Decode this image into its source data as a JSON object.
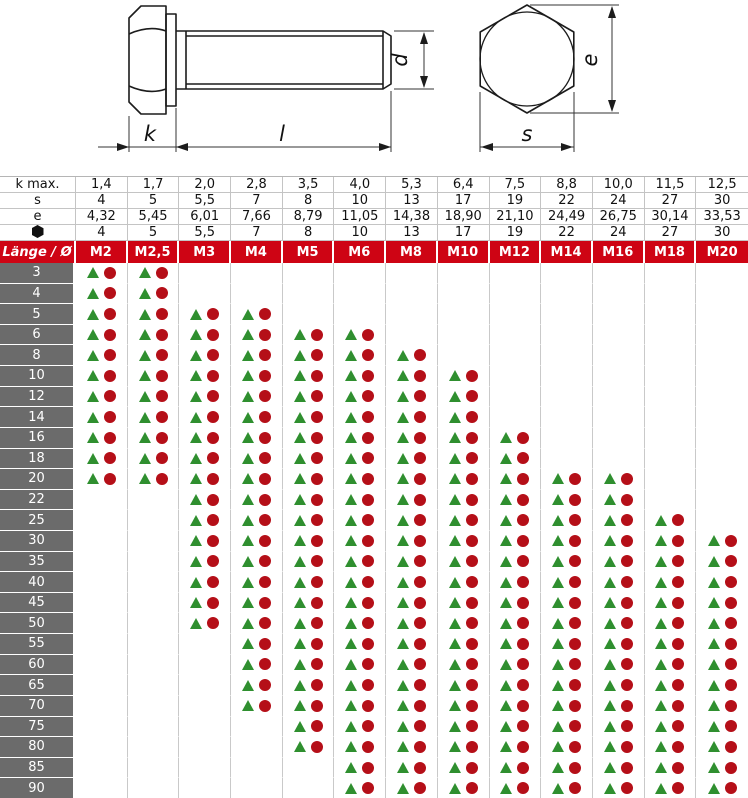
{
  "drawing": {
    "dim_labels": {
      "head_height": "k",
      "shank_length": "l",
      "diameter": "d",
      "corner_width": "e",
      "flat_width": "s"
    }
  },
  "spec": {
    "rows": [
      {
        "label": "k max.",
        "values": [
          "1,4",
          "1,7",
          "2,0",
          "2,8",
          "3,5",
          "4,0",
          "5,3",
          "6,4",
          "7,5",
          "8,8",
          "10,0",
          "11,5",
          "12,5"
        ]
      },
      {
        "label": "s",
        "values": [
          "4",
          "5",
          "5,5",
          "7",
          "8",
          "10",
          "13",
          "17",
          "19",
          "22",
          "24",
          "27",
          "30"
        ]
      },
      {
        "label": "e",
        "values": [
          "4,32",
          "5,45",
          "6,01",
          "7,66",
          "8,79",
          "11,05",
          "14,38",
          "18,90",
          "21,10",
          "24,49",
          "26,75",
          "30,14",
          "33,53"
        ]
      },
      {
        "label": "",
        "icon": "black-hexagon",
        "values": [
          "4",
          "5",
          "5,5",
          "7",
          "8",
          "10",
          "13",
          "17",
          "19",
          "22",
          "24",
          "27",
          "30"
        ]
      }
    ]
  },
  "table": {
    "corner_label": "Länge / Ø",
    "columns": [
      "M2",
      "M2,5",
      "M3",
      "M4",
      "M5",
      "M6",
      "M8",
      "M10",
      "M12",
      "M14",
      "M16",
      "M18",
      "M20"
    ],
    "rows": [
      {
        "length": "3",
        "cells": [
          1,
          1,
          0,
          0,
          0,
          0,
          0,
          0,
          0,
          0,
          0,
          0,
          0
        ]
      },
      {
        "length": "4",
        "cells": [
          1,
          1,
          0,
          0,
          0,
          0,
          0,
          0,
          0,
          0,
          0,
          0,
          0
        ]
      },
      {
        "length": "5",
        "cells": [
          1,
          1,
          1,
          1,
          0,
          0,
          0,
          0,
          0,
          0,
          0,
          0,
          0
        ]
      },
      {
        "length": "6",
        "cells": [
          1,
          1,
          1,
          1,
          1,
          1,
          0,
          0,
          0,
          0,
          0,
          0,
          0
        ]
      },
      {
        "length": "8",
        "cells": [
          1,
          1,
          1,
          1,
          1,
          1,
          1,
          0,
          0,
          0,
          0,
          0,
          0
        ]
      },
      {
        "length": "10",
        "cells": [
          1,
          1,
          1,
          1,
          1,
          1,
          1,
          1,
          0,
          0,
          0,
          0,
          0
        ]
      },
      {
        "length": "12",
        "cells": [
          1,
          1,
          1,
          1,
          1,
          1,
          1,
          1,
          0,
          0,
          0,
          0,
          0
        ]
      },
      {
        "length": "14",
        "cells": [
          1,
          1,
          1,
          1,
          1,
          1,
          1,
          1,
          0,
          0,
          0,
          0,
          0
        ]
      },
      {
        "length": "16",
        "cells": [
          1,
          1,
          1,
          1,
          1,
          1,
          1,
          1,
          1,
          0,
          0,
          0,
          0
        ]
      },
      {
        "length": "18",
        "cells": [
          1,
          1,
          1,
          1,
          1,
          1,
          1,
          1,
          1,
          0,
          0,
          0,
          0
        ]
      },
      {
        "length": "20",
        "cells": [
          1,
          1,
          1,
          1,
          1,
          1,
          1,
          1,
          1,
          1,
          1,
          0,
          0
        ]
      },
      {
        "length": "22",
        "cells": [
          0,
          0,
          1,
          1,
          1,
          1,
          1,
          1,
          1,
          1,
          1,
          0,
          0
        ]
      },
      {
        "length": "25",
        "cells": [
          0,
          0,
          1,
          1,
          1,
          1,
          1,
          1,
          1,
          1,
          1,
          1,
          0
        ]
      },
      {
        "length": "30",
        "cells": [
          0,
          0,
          1,
          1,
          1,
          1,
          1,
          1,
          1,
          1,
          1,
          1,
          1
        ]
      },
      {
        "length": "35",
        "cells": [
          0,
          0,
          1,
          1,
          1,
          1,
          1,
          1,
          1,
          1,
          1,
          1,
          1
        ]
      },
      {
        "length": "40",
        "cells": [
          0,
          0,
          1,
          1,
          1,
          1,
          1,
          1,
          1,
          1,
          1,
          1,
          1
        ]
      },
      {
        "length": "45",
        "cells": [
          0,
          0,
          1,
          1,
          1,
          1,
          1,
          1,
          1,
          1,
          1,
          1,
          1
        ]
      },
      {
        "length": "50",
        "cells": [
          0,
          0,
          1,
          1,
          1,
          1,
          1,
          1,
          1,
          1,
          1,
          1,
          1
        ]
      },
      {
        "length": "55",
        "cells": [
          0,
          0,
          0,
          1,
          1,
          1,
          1,
          1,
          1,
          1,
          1,
          1,
          1
        ]
      },
      {
        "length": "60",
        "cells": [
          0,
          0,
          0,
          1,
          1,
          1,
          1,
          1,
          1,
          1,
          1,
          1,
          1
        ]
      },
      {
        "length": "65",
        "cells": [
          0,
          0,
          0,
          1,
          1,
          1,
          1,
          1,
          1,
          1,
          1,
          1,
          1
        ]
      },
      {
        "length": "70",
        "cells": [
          0,
          0,
          0,
          1,
          1,
          1,
          1,
          1,
          1,
          1,
          1,
          1,
          1
        ]
      },
      {
        "length": "75",
        "cells": [
          0,
          0,
          0,
          0,
          1,
          1,
          1,
          1,
          1,
          1,
          1,
          1,
          1
        ]
      },
      {
        "length": "80",
        "cells": [
          0,
          0,
          0,
          0,
          1,
          1,
          1,
          1,
          1,
          1,
          1,
          1,
          1
        ]
      },
      {
        "length": "85",
        "cells": [
          0,
          0,
          0,
          0,
          0,
          1,
          1,
          1,
          1,
          1,
          1,
          1,
          1
        ]
      },
      {
        "length": "90",
        "cells": [
          0,
          0,
          0,
          0,
          0,
          1,
          1,
          1,
          1,
          1,
          1,
          1,
          1
        ]
      }
    ]
  },
  "colors": {
    "header_red": "#ce0414",
    "label_gray": "#6b6b6b",
    "row_alt_gray": "#e4e4e4",
    "triangle_green": "#2f8f2f",
    "circle_red": "#b50f18"
  }
}
